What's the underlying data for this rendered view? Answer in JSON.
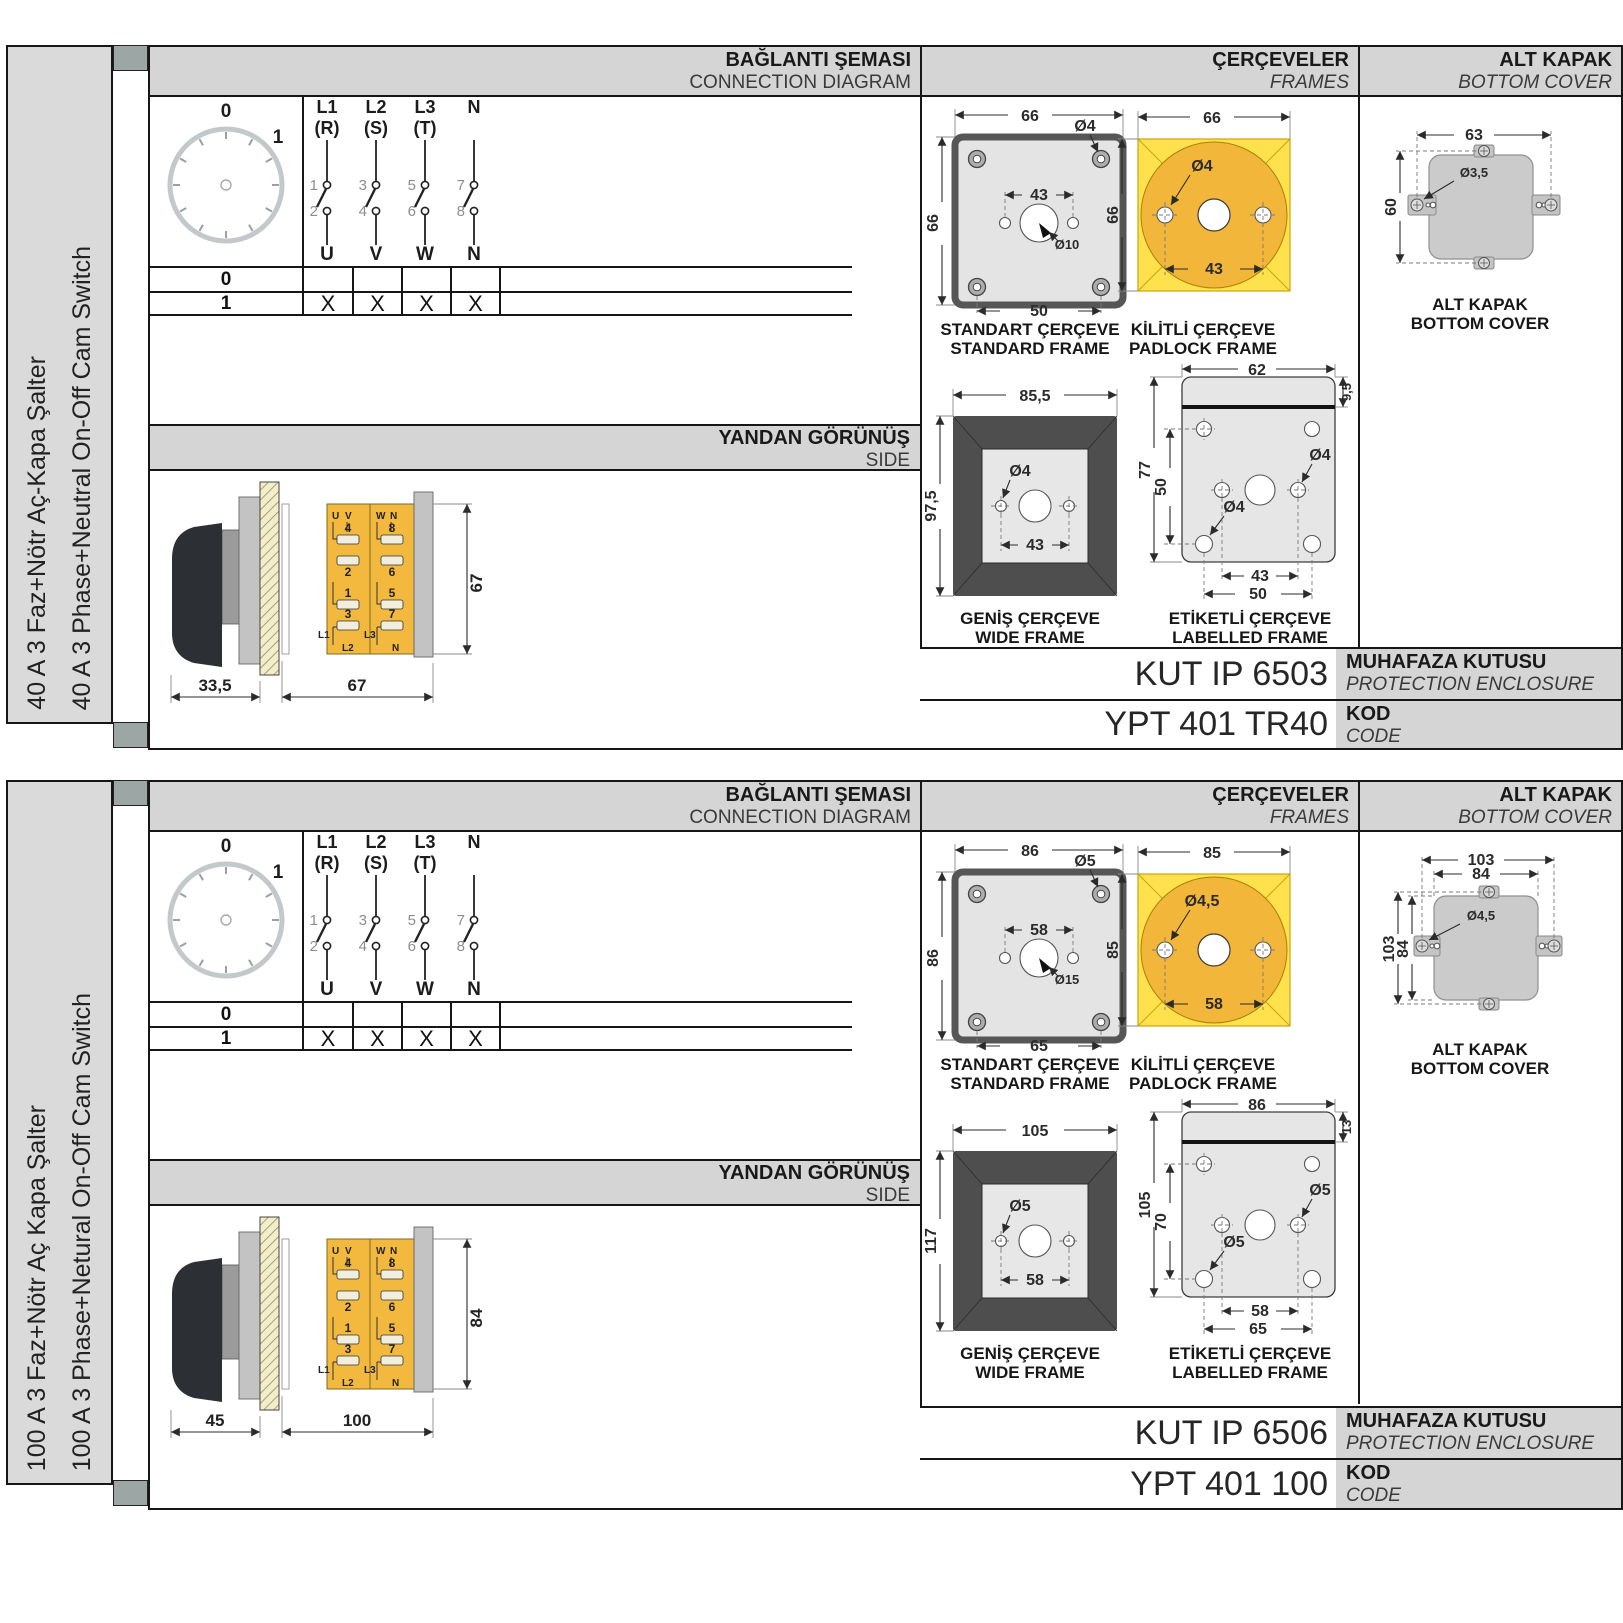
{
  "colors": {
    "frame_yellow": "#ffe14e",
    "padlock_circle": "#f2b63a",
    "switch_body_amber": "#f3b93f",
    "header_gray": "#d5d5d5",
    "sidebar_gray": "#dadada",
    "tab_gray": "#9ca6a4",
    "dark_frame": "#4e4e4e"
  },
  "sections": [
    {
      "sidebar": {
        "tr": "40 A 3 Faz+Nötr Aç-Kapa Şalter",
        "en": "40 A 3 Phase+Neutral On-Off Cam Switch"
      },
      "headers": {
        "diagram_tr": "BAĞLANTI ŞEMASI",
        "diagram_en": "CONNECTION DIAGRAM",
        "frames_tr": "ÇERÇEVELER",
        "frames_en": "FRAMES",
        "cover_tr": "ALT KAPAK",
        "cover_en": "BOTTOM COVER",
        "side_tr": "YANDAN GÖRÜNÜŞ",
        "side_en": "SIDE"
      },
      "dial": {
        "p0": "0",
        "p1": "1"
      },
      "contacts": [
        {
          "line": "L1",
          "phase": "(R)",
          "top": "1",
          "bottom": "2",
          "out": "U"
        },
        {
          "line": "L2",
          "phase": "(S)",
          "top": "3",
          "bottom": "4",
          "out": "V"
        },
        {
          "line": "L3",
          "phase": "(T)",
          "top": "5",
          "bottom": "6",
          "out": "W"
        },
        {
          "line": "N",
          "phase": "",
          "top": "7",
          "bottom": "8",
          "out": "N"
        }
      ],
      "table": {
        "row0": "0",
        "row1": "1",
        "marks": [
          "X",
          "X",
          "X",
          "X"
        ]
      },
      "sideview": {
        "u": "U",
        "v": "V",
        "w": "W",
        "n": "N",
        "t4": "4",
        "t2": "2",
        "t1": "1",
        "t3": "3",
        "t8": "8",
        "t6": "6",
        "t5": "5",
        "t7": "7",
        "l1": "L1",
        "l2": "L2",
        "l3": "L3",
        "ln": "N",
        "height": "67",
        "depth": "33,5",
        "width": "67"
      },
      "frames": {
        "standard": {
          "tr": "STANDART ÇERÇEVE",
          "en": "STANDARD FRAME",
          "w": "66",
          "h": "66",
          "hole": "Ø4",
          "span": "43",
          "center": "Ø10",
          "bottom": "50"
        },
        "padlock": {
          "tr": "KİLİTLİ ÇERÇEVE",
          "en": "PADLOCK FRAME",
          "w": "66",
          "h": "66",
          "hole": "Ø4",
          "span": "43"
        },
        "wide": {
          "tr": "GENİŞ ÇERÇEVE",
          "en": "WIDE FRAME",
          "w": "85,5",
          "h": "97,5",
          "hole": "Ø4",
          "span": "43"
        },
        "labelled": {
          "tr": "ETİKETLİ ÇERÇEVE",
          "en": "LABELLED FRAME",
          "w": "62",
          "strip": "9,5",
          "h": "77",
          "inner": "50",
          "hole_mid": "Ø4",
          "hole_bot": "Ø4",
          "span": "43",
          "bottom": "50"
        }
      },
      "cover": {
        "tr": "ALT KAPAK",
        "en": "BOTTOM COVER",
        "w": "63",
        "h": "60",
        "hole": "Ø3,5"
      },
      "codes": {
        "enclosure": "KUT IP 6503",
        "enclosure_tr": "MUHAFAZA KUTUSU",
        "enclosure_en": "PROTECTION ENCLOSURE",
        "code": "YPT 401 TR40",
        "code_tr": "KOD",
        "code_en": "CODE"
      }
    },
    {
      "sidebar": {
        "tr": "100 A 3 Faz+Nötr Aç Kapa Şalter",
        "en": "100 A 3 Phase+Netural On-Off Cam Switch"
      },
      "headers": {
        "diagram_tr": "BAĞLANTI ŞEMASI",
        "diagram_en": "CONNECTION DIAGRAM",
        "frames_tr": "ÇERÇEVELER",
        "frames_en": "FRAMES",
        "cover_tr": "ALT KAPAK",
        "cover_en": "BOTTOM COVER",
        "side_tr": "YANDAN GÖRÜNÜŞ",
        "side_en": "SIDE"
      },
      "dial": {
        "p0": "0",
        "p1": "1"
      },
      "contacts": [
        {
          "line": "L1",
          "phase": "(R)",
          "top": "1",
          "bottom": "2",
          "out": "U"
        },
        {
          "line": "L2",
          "phase": "(S)",
          "top": "3",
          "bottom": "4",
          "out": "V"
        },
        {
          "line": "L3",
          "phase": "(T)",
          "top": "5",
          "bottom": "6",
          "out": "W"
        },
        {
          "line": "N",
          "phase": "",
          "top": "7",
          "bottom": "8",
          "out": "N"
        }
      ],
      "table": {
        "row0": "0",
        "row1": "1",
        "marks": [
          "X",
          "X",
          "X",
          "X"
        ]
      },
      "sideview": {
        "u": "U",
        "v": "V",
        "w": "W",
        "n": "N",
        "t4": "4",
        "t2": "2",
        "t1": "1",
        "t3": "3",
        "t8": "8",
        "t6": "6",
        "t5": "5",
        "t7": "7",
        "l1": "L1",
        "l2": "L2",
        "l3": "L3",
        "ln": "N",
        "height": "84",
        "depth": "45",
        "width": "100"
      },
      "frames": {
        "standard": {
          "tr": "STANDART ÇERÇEVE",
          "en": "STANDARD FRAME",
          "w": "86",
          "h": "86",
          "hole": "Ø5",
          "span": "58",
          "center": "Ø15",
          "bottom": "65"
        },
        "padlock": {
          "tr": "KİLİTLİ ÇERÇEVE",
          "en": "PADLOCK FRAME",
          "w": "85",
          "h": "85",
          "hole": "Ø4,5",
          "span": "58"
        },
        "wide": {
          "tr": "GENİŞ ÇERÇEVE",
          "en": "WIDE FRAME",
          "w": "105",
          "h": "117",
          "hole": "Ø5",
          "span": "58"
        },
        "labelled": {
          "tr": "ETİKETLİ ÇERÇEVE",
          "en": "LABELLED FRAME",
          "w": "86",
          "strip": "13",
          "h": "105",
          "inner": "70",
          "hole_mid": "Ø5",
          "hole_bot": "Ø5",
          "span": "58",
          "bottom": "65"
        }
      },
      "cover": {
        "tr": "ALT KAPAK",
        "en": "BOTTOM COVER",
        "w_out": "103",
        "w_in": "84",
        "h_out": "103",
        "h_in": "84",
        "hole": "Ø4,5"
      },
      "codes": {
        "enclosure": "KUT IP 6506",
        "enclosure_tr": "MUHAFAZA KUTUSU",
        "enclosure_en": "PROTECTION ENCLOSURE",
        "code": "YPT 401 100",
        "code_tr": "KOD",
        "code_en": "CODE"
      }
    }
  ]
}
